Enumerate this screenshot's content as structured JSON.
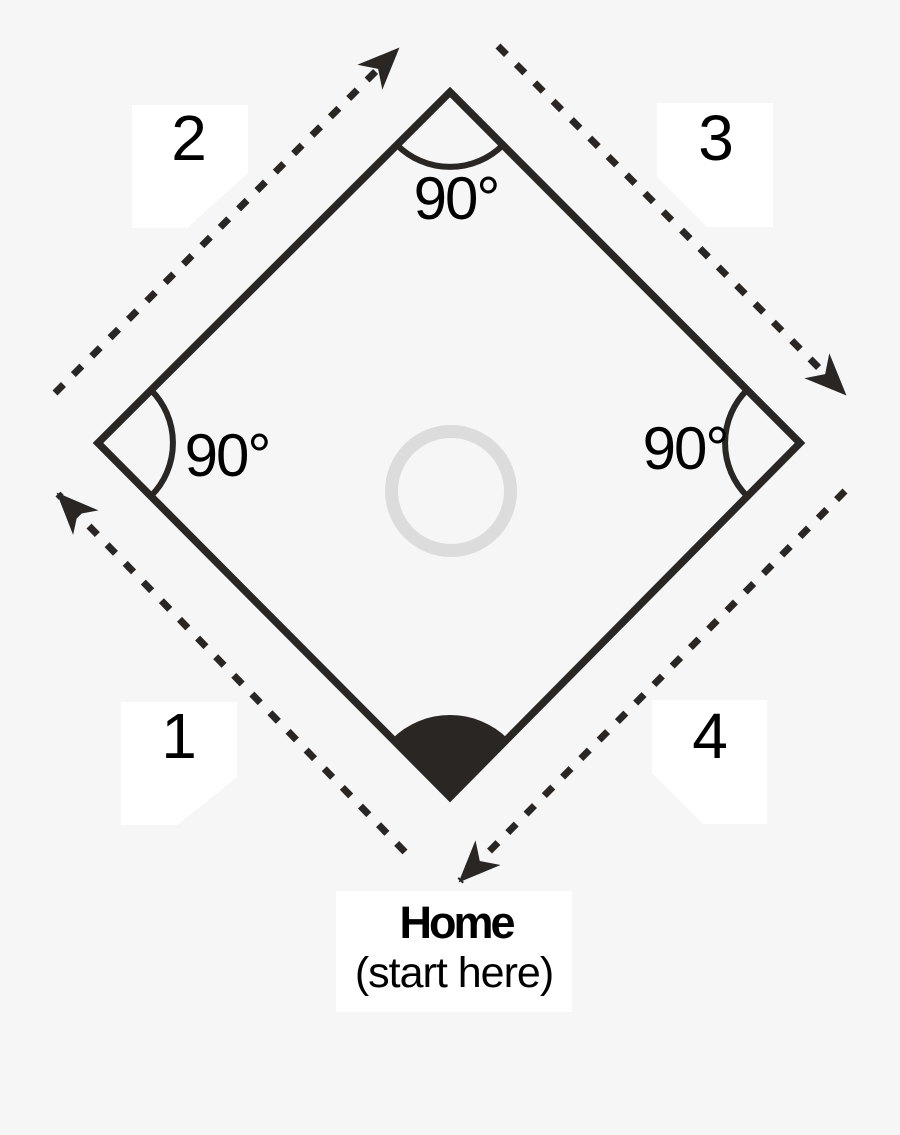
{
  "diagram": {
    "type": "baseball-diamond-square",
    "side_labels": [
      "1",
      "2",
      "3",
      "4"
    ],
    "angles": {
      "top": "90°",
      "left": "90°",
      "right": "90°"
    },
    "home": {
      "title": "Home",
      "subtitle": "(start here)"
    },
    "icons": {
      "arrowheads": "arrowhead-icon (solid triangle on dashed path, one per side, pointing clockwise around the square)",
      "home_plate_angle": "filled-angle-sector-icon at bottom vertex",
      "pitcher_circle": "gray-ring-icon at center"
    },
    "colors": {
      "background": "#f6f6f6",
      "line": "#292623",
      "ring": "#dcdcdc",
      "label_box": "#ffffff",
      "text": "#000000"
    }
  }
}
